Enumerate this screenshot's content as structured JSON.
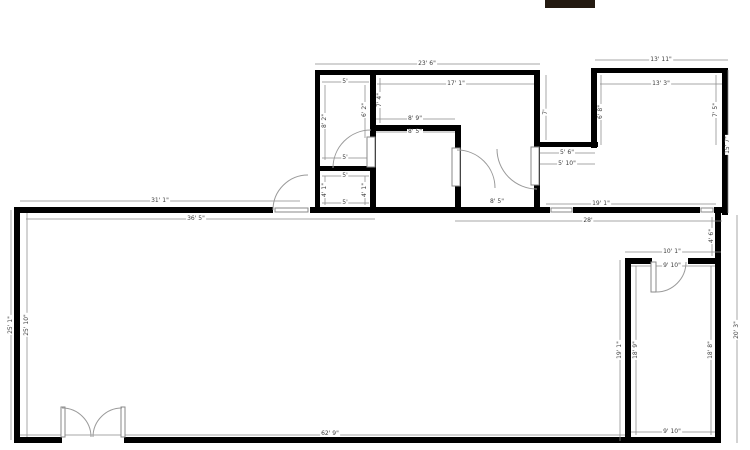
{
  "title_block": {
    "color": "#241a11"
  },
  "plan": {
    "wall_color": "#000000",
    "dim_text_color": "#3d3d3d",
    "door_stroke_color": "#9a9a9a",
    "dim_line_color": "#8a8a8a",
    "dimensions": [
      {
        "text": "23' 6\"",
        "x": 427,
        "y": 64,
        "rot": 0
      },
      {
        "text": "17' 1\"",
        "x": 456,
        "y": 84,
        "rot": 0
      },
      {
        "text": "13' 11\"",
        "x": 661,
        "y": 60,
        "rot": 0
      },
      {
        "text": "13' 3\"",
        "x": 661,
        "y": 84,
        "rot": 0
      },
      {
        "text": "5'",
        "x": 345,
        "y": 82,
        "rot": 0
      },
      {
        "text": "5'",
        "x": 345,
        "y": 158,
        "rot": 0
      },
      {
        "text": "8' 2\"",
        "x": 325,
        "y": 121,
        "rot": 90
      },
      {
        "text": "6' 2\"",
        "x": 365,
        "y": 110,
        "rot": 90
      },
      {
        "text": "7' 4\"",
        "x": 380,
        "y": 100,
        "rot": 90
      },
      {
        "text": "8' 9\"",
        "x": 415,
        "y": 119,
        "rot": 0
      },
      {
        "text": "8' 5\"",
        "x": 415,
        "y": 132,
        "rot": 0
      },
      {
        "text": "5'",
        "x": 345,
        "y": 176,
        "rot": 0
      },
      {
        "text": "5'",
        "x": 345,
        "y": 203,
        "rot": 0
      },
      {
        "text": "4' 1\"",
        "x": 325,
        "y": 190,
        "rot": 90
      },
      {
        "text": "4' 1\"",
        "x": 365,
        "y": 190,
        "rot": 90
      },
      {
        "text": "7'",
        "x": 546,
        "y": 112,
        "rot": 90
      },
      {
        "text": "6' 8\"",
        "x": 601,
        "y": 112,
        "rot": 90
      },
      {
        "text": "7' 5\"",
        "x": 716,
        "y": 110,
        "rot": 90
      },
      {
        "text": "15' 7\"",
        "x": 728,
        "y": 145,
        "rot": 90
      },
      {
        "text": "5' 6\"",
        "x": 567,
        "y": 153,
        "rot": 0
      },
      {
        "text": "5' 10\"",
        "x": 567,
        "y": 164,
        "rot": 0
      },
      {
        "text": "31' 1\"",
        "x": 160,
        "y": 201,
        "rot": 0
      },
      {
        "text": "36' 5\"",
        "x": 196,
        "y": 219,
        "rot": 0
      },
      {
        "text": "8' 5\"",
        "x": 497,
        "y": 202,
        "rot": 0
      },
      {
        "text": "19' 1\"",
        "x": 601,
        "y": 204,
        "rot": 0
      },
      {
        "text": "28'",
        "x": 588,
        "y": 221,
        "rot": 0
      },
      {
        "text": "25' 1\"",
        "x": 11,
        "y": 325,
        "rot": 90
      },
      {
        "text": "25' 10\"",
        "x": 27,
        "y": 325,
        "rot": 90
      },
      {
        "text": "4' 6\"",
        "x": 712,
        "y": 236,
        "rot": 90
      },
      {
        "text": "20' 3\"",
        "x": 737,
        "y": 330,
        "rot": 90
      },
      {
        "text": "10' 1\"",
        "x": 672,
        "y": 252,
        "rot": 0
      },
      {
        "text": "9' 10\"",
        "x": 672,
        "y": 266,
        "rot": 0
      },
      {
        "text": "19' 1\"",
        "x": 620,
        "y": 350,
        "rot": 90
      },
      {
        "text": "18' 9\"",
        "x": 636,
        "y": 350,
        "rot": 90
      },
      {
        "text": "18' 8\"",
        "x": 711,
        "y": 350,
        "rot": 90
      },
      {
        "text": "9' 10\"",
        "x": 672,
        "y": 432,
        "rot": 0
      },
      {
        "text": "62' 9\"",
        "x": 330,
        "y": 434,
        "rot": 0
      }
    ]
  }
}
